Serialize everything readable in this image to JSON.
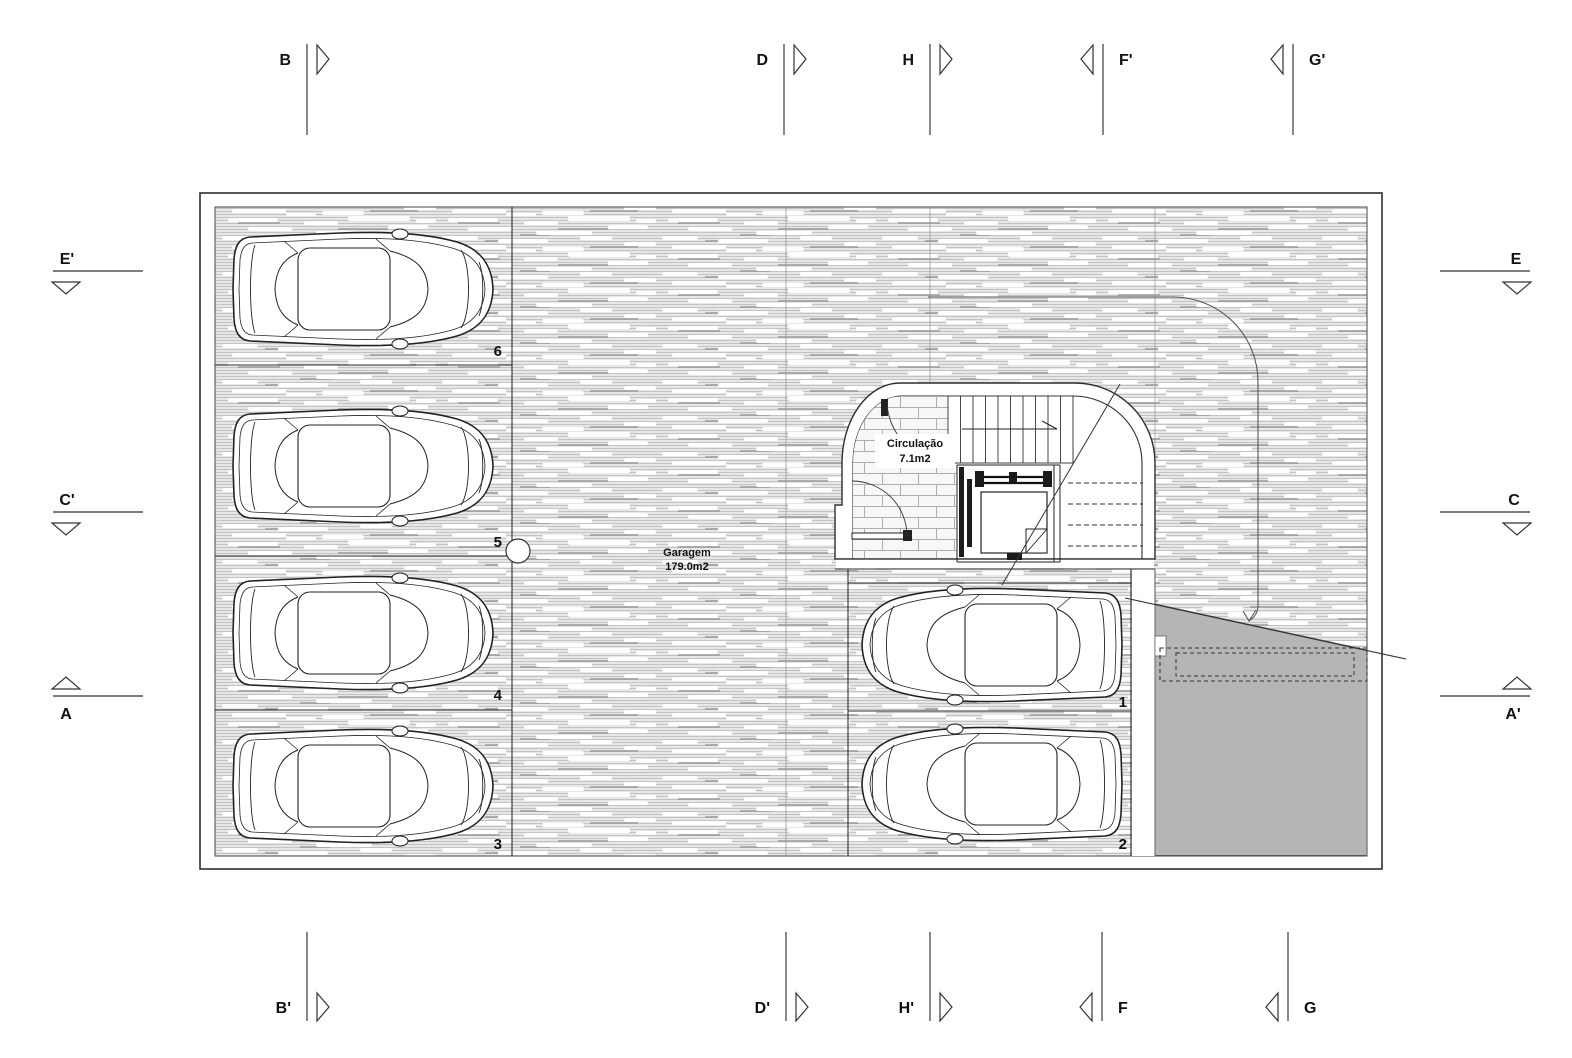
{
  "drawing": {
    "rooms": {
      "garage": {
        "name": "Garagem",
        "area": "179.0m2"
      },
      "circulation": {
        "name": "Circulação",
        "area": "7.1m2"
      }
    },
    "stalls": {
      "n1": "1",
      "n2": "2",
      "n3": "3",
      "n4": "4",
      "n5": "5",
      "n6": "6"
    },
    "sections": {
      "top": {
        "b": "B",
        "d": "D",
        "h": "H",
        "f2": "F'",
        "g2": "G'"
      },
      "bottom": {
        "b2": "B'",
        "d2": "D'",
        "h2": "H'",
        "f": "F",
        "g": "G"
      },
      "left": {
        "e2": "E'",
        "c2": "C'",
        "a": "A"
      },
      "right": {
        "e": "E",
        "c": "C",
        "a2": "A'"
      }
    },
    "colors": {
      "ramp_gray": "#b5b5b5",
      "hatch_line": "#c3c3c3",
      "line_dark": "#2e2e2e"
    }
  }
}
